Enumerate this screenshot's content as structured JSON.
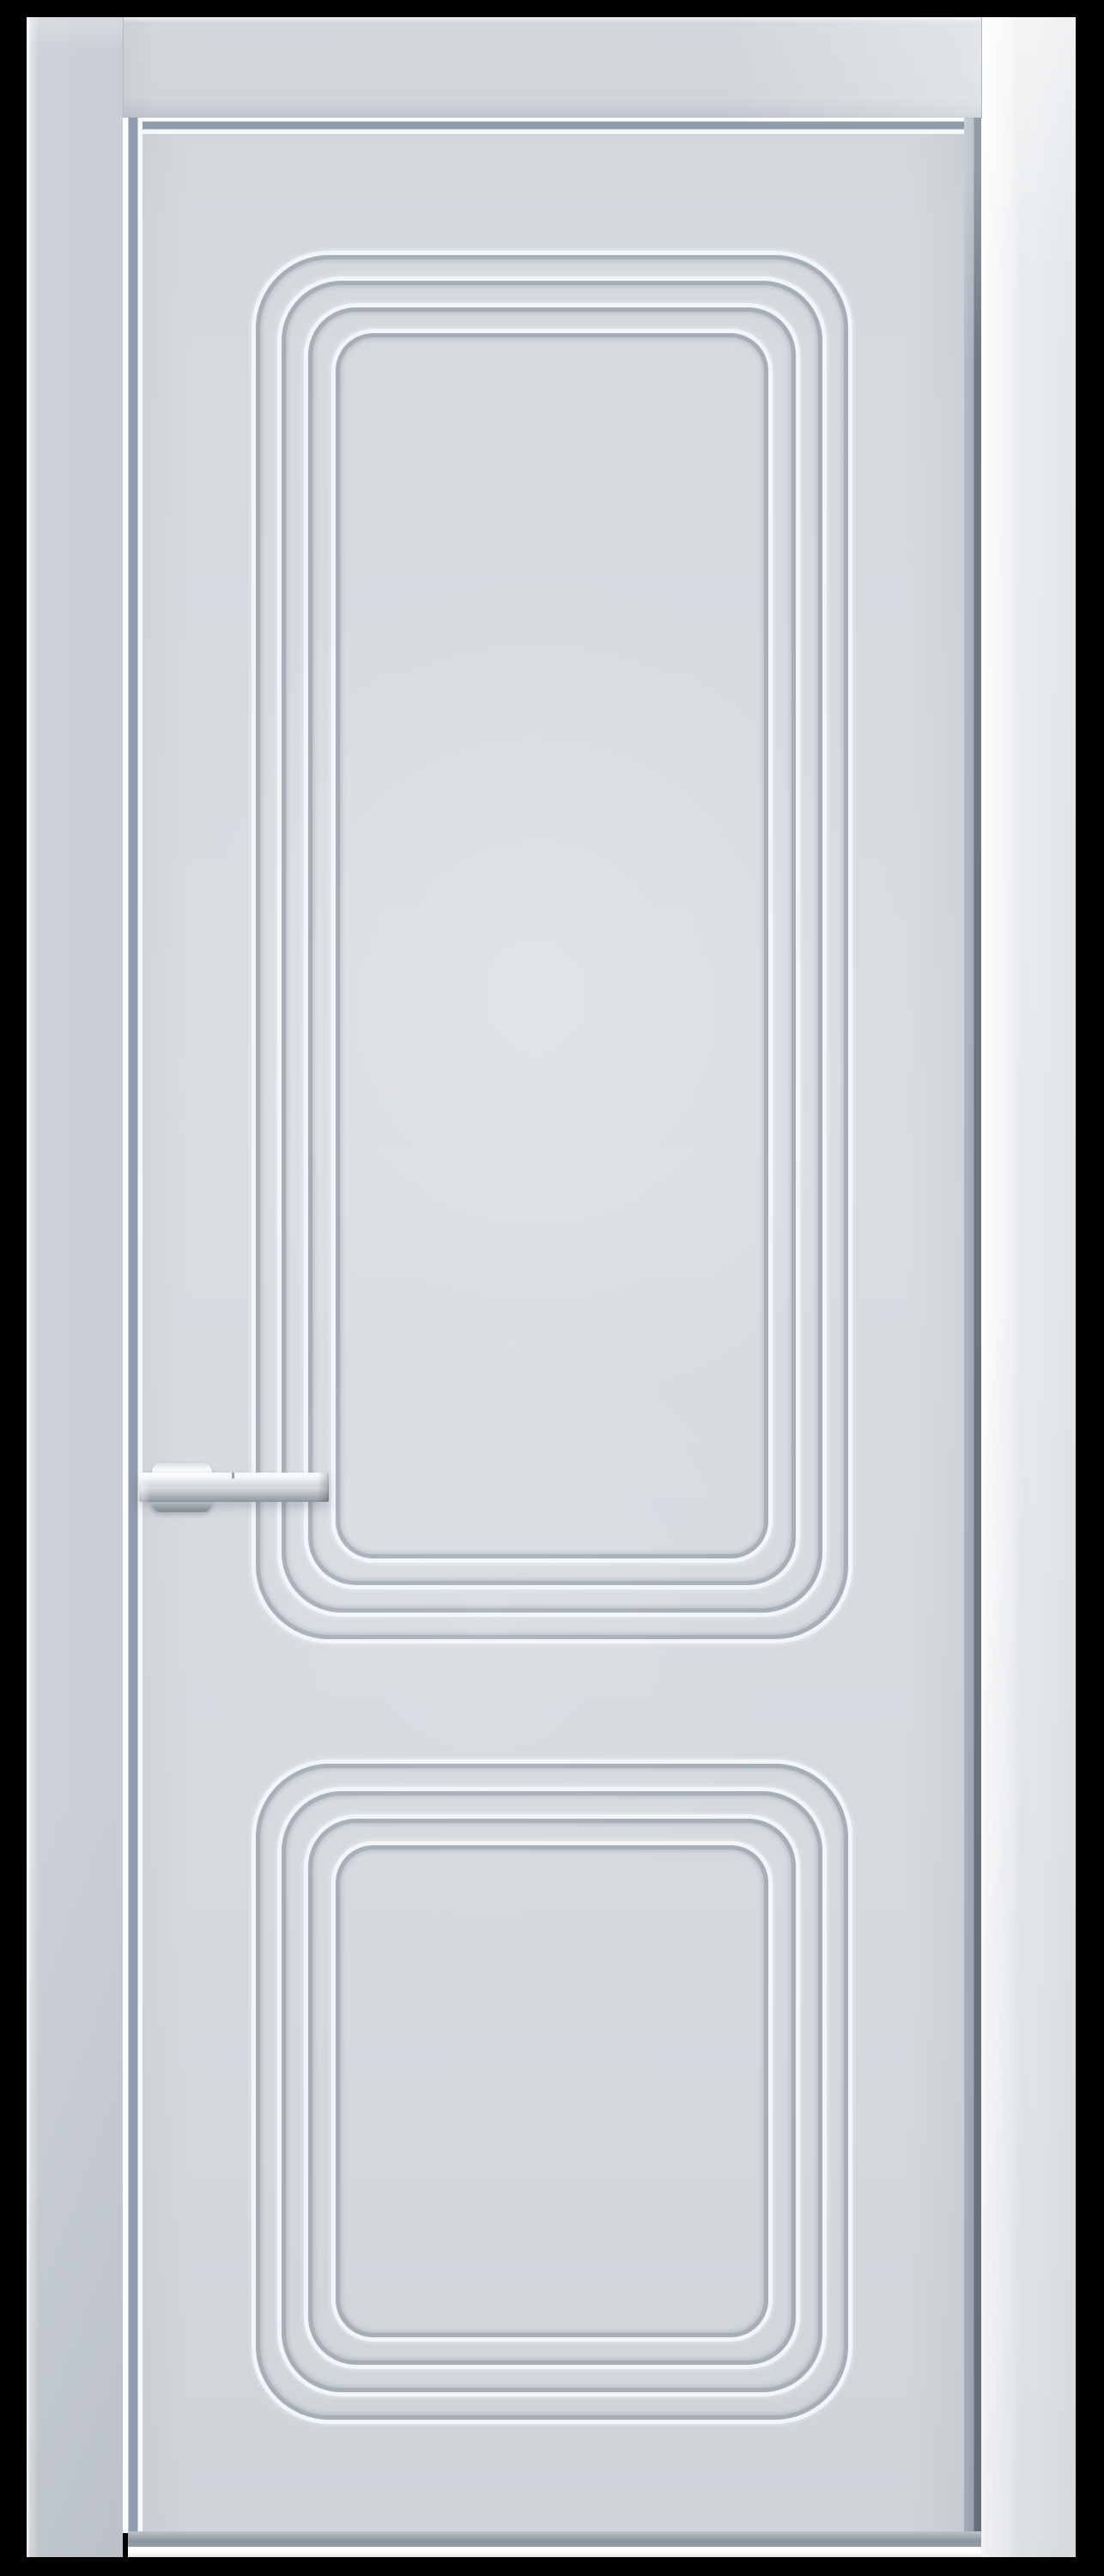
{
  "scene": {
    "description": "Frontal product render of a closed light-gray interior door in a matching frame on a black backdrop",
    "door": {
      "frame": {
        "sides": [
          "left",
          "head",
          "right"
        ],
        "finish": "light gray painted wood"
      },
      "leaf": {
        "finish": "light gray matte enamel"
      },
      "panels": [
        {
          "name": "upper-panel",
          "shape": "tall rounded rectangle",
          "groove_count": 4
        },
        {
          "name": "lower-panel",
          "shape": "square rounded rectangle",
          "groove_count": 4
        }
      ],
      "handle": {
        "type": "lever on cylindrical rose",
        "finish": "satin chrome",
        "position": "left edge, mid height"
      }
    },
    "colors": {
      "backdrop": "#010102",
      "casing_left": "#ccd2d8",
      "casing_head": "#d3d7dc",
      "casing_right": "#e7eaed",
      "leaf": "#d5d9de",
      "leaf_light": "#d9dde2",
      "groove_highlight": "#f3f5f8",
      "groove_shadow": "#a6afb8",
      "gap_shadow": "#8e9dab",
      "gap_shadow_dark": "#6f7883",
      "bottom_shadow": "#8c959f",
      "chrome_light": "#fafbfc",
      "chrome_mid": "#d4d9dd",
      "chrome_dark": "#99a1a8"
    }
  }
}
